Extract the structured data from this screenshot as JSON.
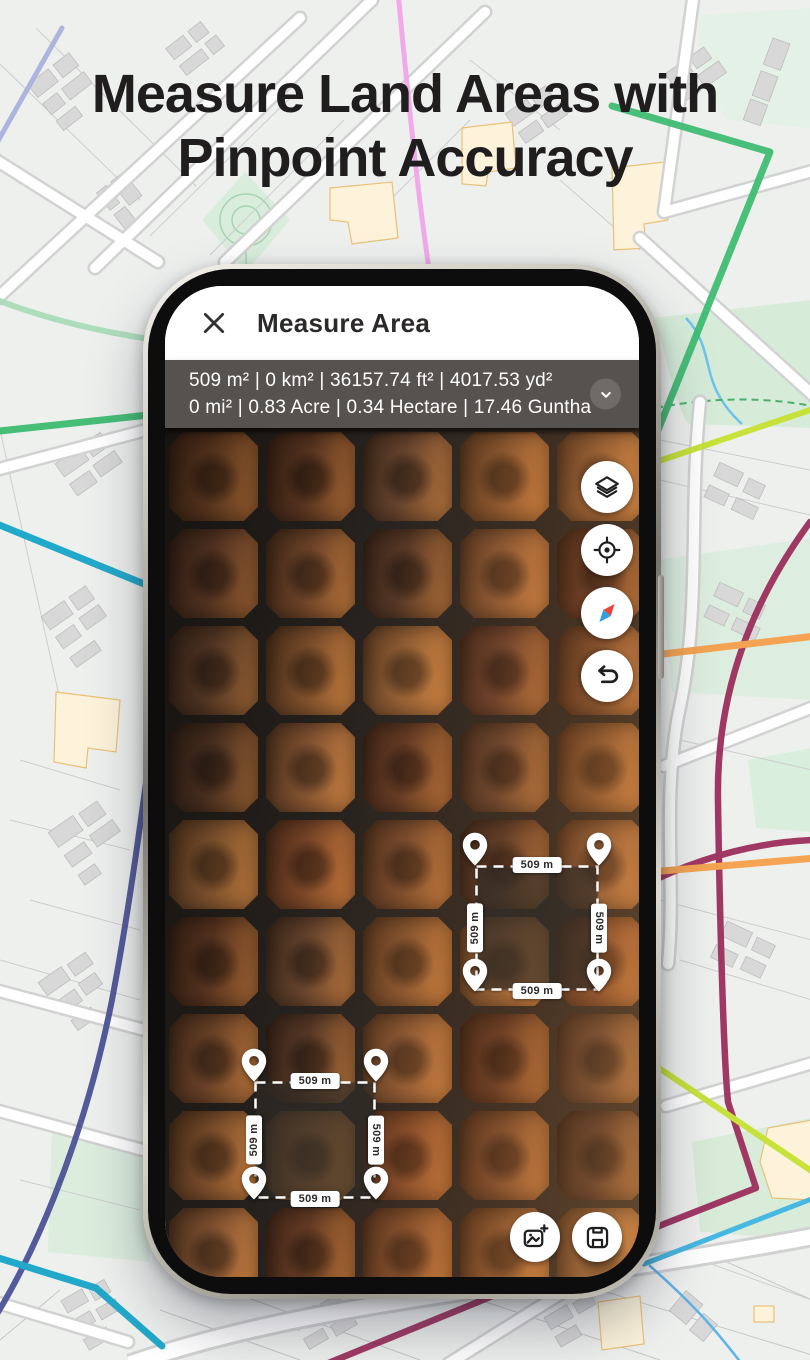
{
  "hero": {
    "title_line1": "Measure Land Areas with",
    "title_line2": "Pinpoint Accuracy"
  },
  "app": {
    "header": {
      "title": "Measure Area",
      "close_icon": "close-icon"
    },
    "measurement_bar": {
      "line1": "509 m² | 0 km² | 36157.74 ft² | 4017.53 yd²",
      "line2": "0 mi² | 0.83 Acre | 0.34 Hectare | 17.46 Guntha",
      "expand_icon": "chevron-down-icon"
    },
    "map_controls": [
      {
        "icon": "layers-icon"
      },
      {
        "icon": "my-location-icon"
      },
      {
        "icon": "compass-icon"
      },
      {
        "icon": "undo-icon"
      }
    ],
    "measured_areas": [
      {
        "labels": {
          "top": "509 m",
          "right": "509 m",
          "bottom": "509 m",
          "left": "509 m"
        }
      },
      {
        "labels": {
          "top": "509 m",
          "right": "509 m",
          "bottom": "509 m",
          "left": "509 m"
        }
      }
    ],
    "action_buttons": [
      {
        "icon": "add-screenshot-icon"
      },
      {
        "icon": "save-icon"
      }
    ]
  },
  "colors": {
    "measurement_bar_bg": "#56524F",
    "hero_text": "#1F1D1E",
    "pin": "#FFFFFF",
    "compass_north": "#E8453C",
    "compass_south": "#2F9FE8"
  }
}
